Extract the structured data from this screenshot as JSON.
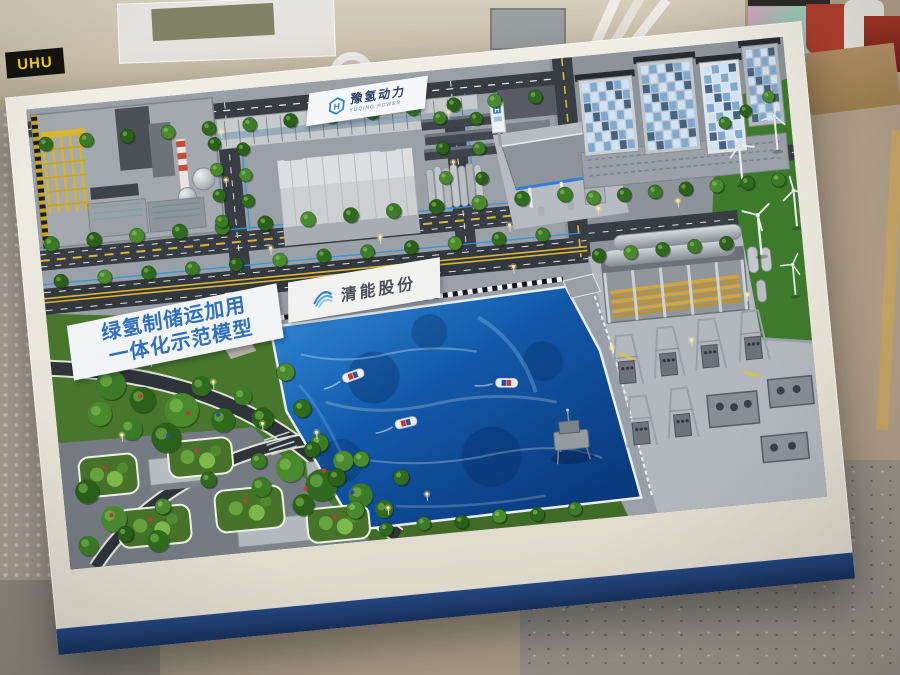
{
  "model": {
    "banner_title": {
      "line1": "绿氢制储运加用",
      "line2": "一体化示范模型"
    },
    "road_banner": {
      "company_name": "清能股份"
    },
    "roof_sign": {
      "name_cn": "豫氢动力",
      "name_en": "YUQING POWER",
      "logo_letter": "H"
    },
    "station_sign": {
      "logo_letter": "H"
    }
  },
  "workshop": {
    "glue_box_label": "UHU"
  },
  "palette": {
    "water_deep": "#0a3a7e",
    "water_mid": "#1258a8",
    "water_light": "#2e86d4",
    "lawn_green": "#47762c",
    "wind_lawn_green": "#3e7a2c",
    "road_asphalt": "#383d44",
    "concrete_gray": "#a9afb5",
    "frame_white": "#efece3",
    "skirt_navy": "#1d3a6e",
    "accent_blue": "#2f7fd6",
    "banner_text_blue": "#2e6fc0",
    "hazard_yellow": "#d9b637",
    "chimney_red": "#c84a38",
    "tube_yellow": "#d2a53c"
  }
}
